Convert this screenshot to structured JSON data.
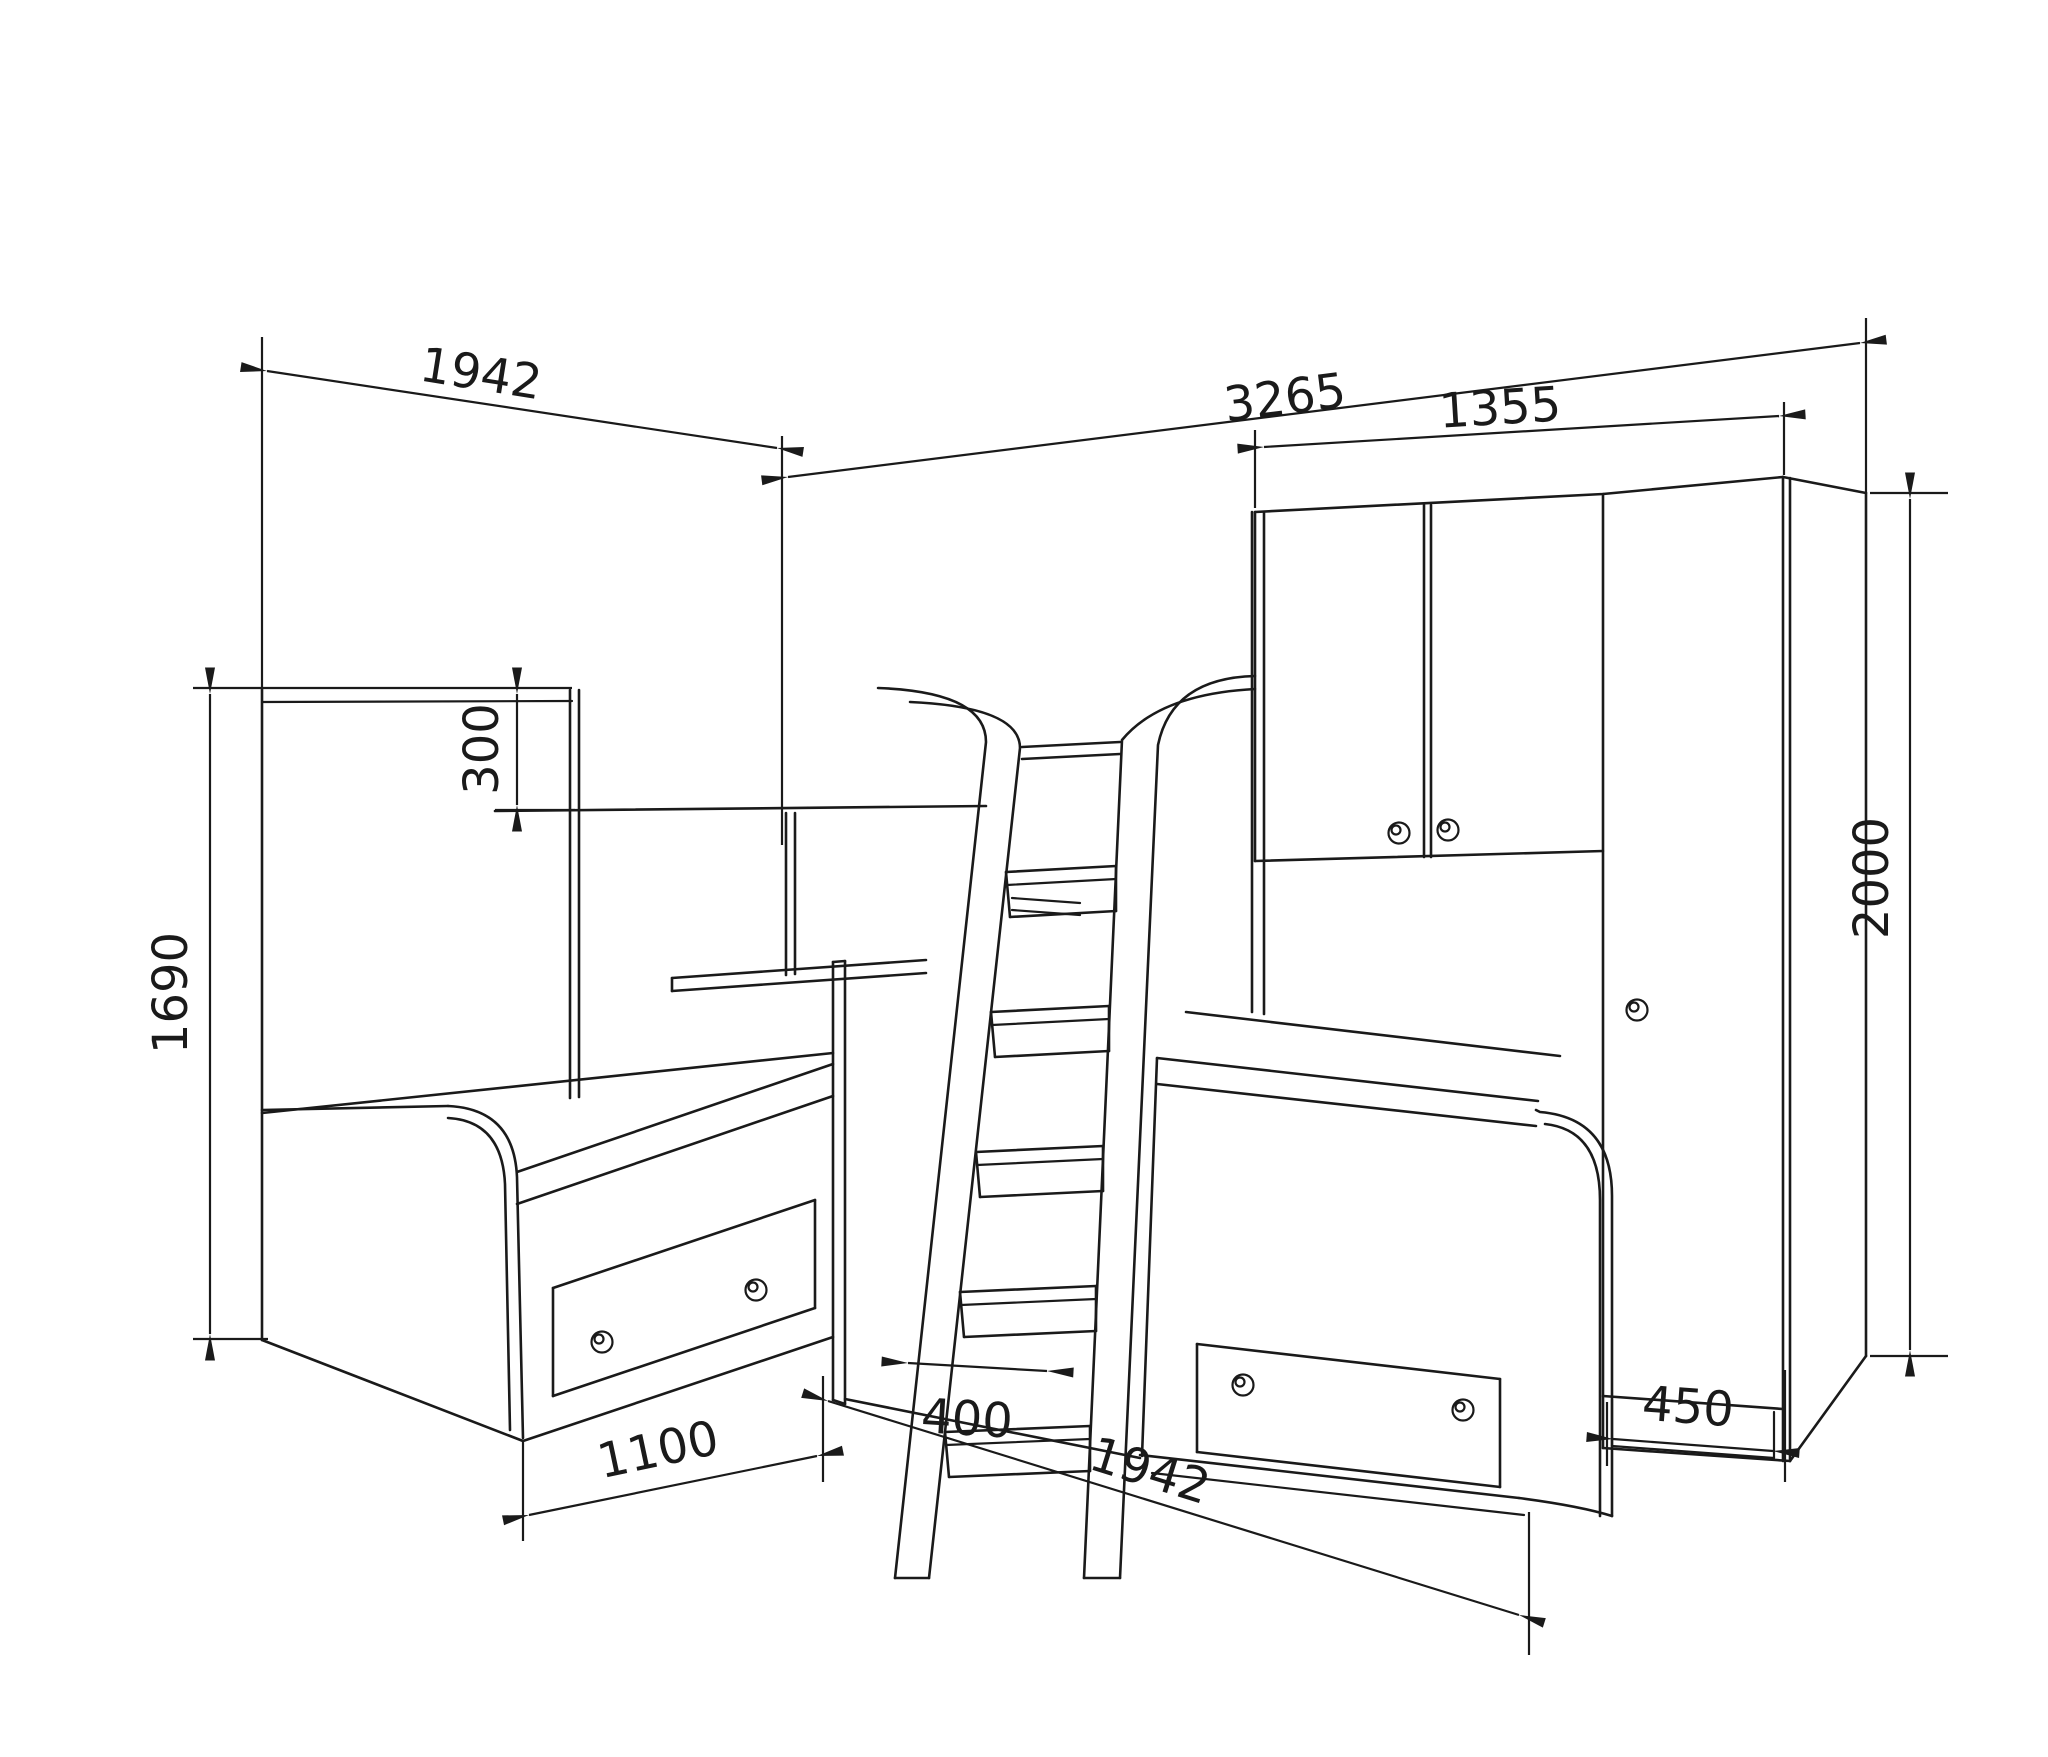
{
  "drawing": {
    "kind": "furniture-dimension-diagram",
    "background": "#ffffff",
    "line_color": "#1a1a1a",
    "subject": "Corner bunk-bed set: two lower beds with drawers, loft bed with safety rail, hook-on ladder, desk shelf, overhead two-door cabinet and tall wardrobe",
    "units_implied": "mm"
  },
  "dimensions": {
    "left_bed_length": {
      "value": "1942",
      "placement": "top-left, slanted along left wall"
    },
    "total_width": {
      "value": "3265",
      "placement": "top, slanted along right wall"
    },
    "cabinet_width": {
      "value": "1355",
      "placement": "above overhead cabinet"
    },
    "bunk_rail_height": {
      "value": "300",
      "placement": "vertical, loft-bed safety rail"
    },
    "left_height": {
      "value": "1690",
      "placement": "vertical, far left"
    },
    "wardrobe_height": {
      "value": "2000",
      "placement": "vertical, far right"
    },
    "left_bed_width": {
      "value": "1100",
      "placement": "bottom left, bed end width"
    },
    "ladder_width": {
      "value": "400",
      "placement": "bottom center, ladder width"
    },
    "right_bed_length": {
      "value": "1942",
      "placement": "bottom right, along right bed"
    },
    "wardrobe_depth": {
      "value": "450",
      "placement": "bottom far right, wardrobe depth"
    }
  }
}
